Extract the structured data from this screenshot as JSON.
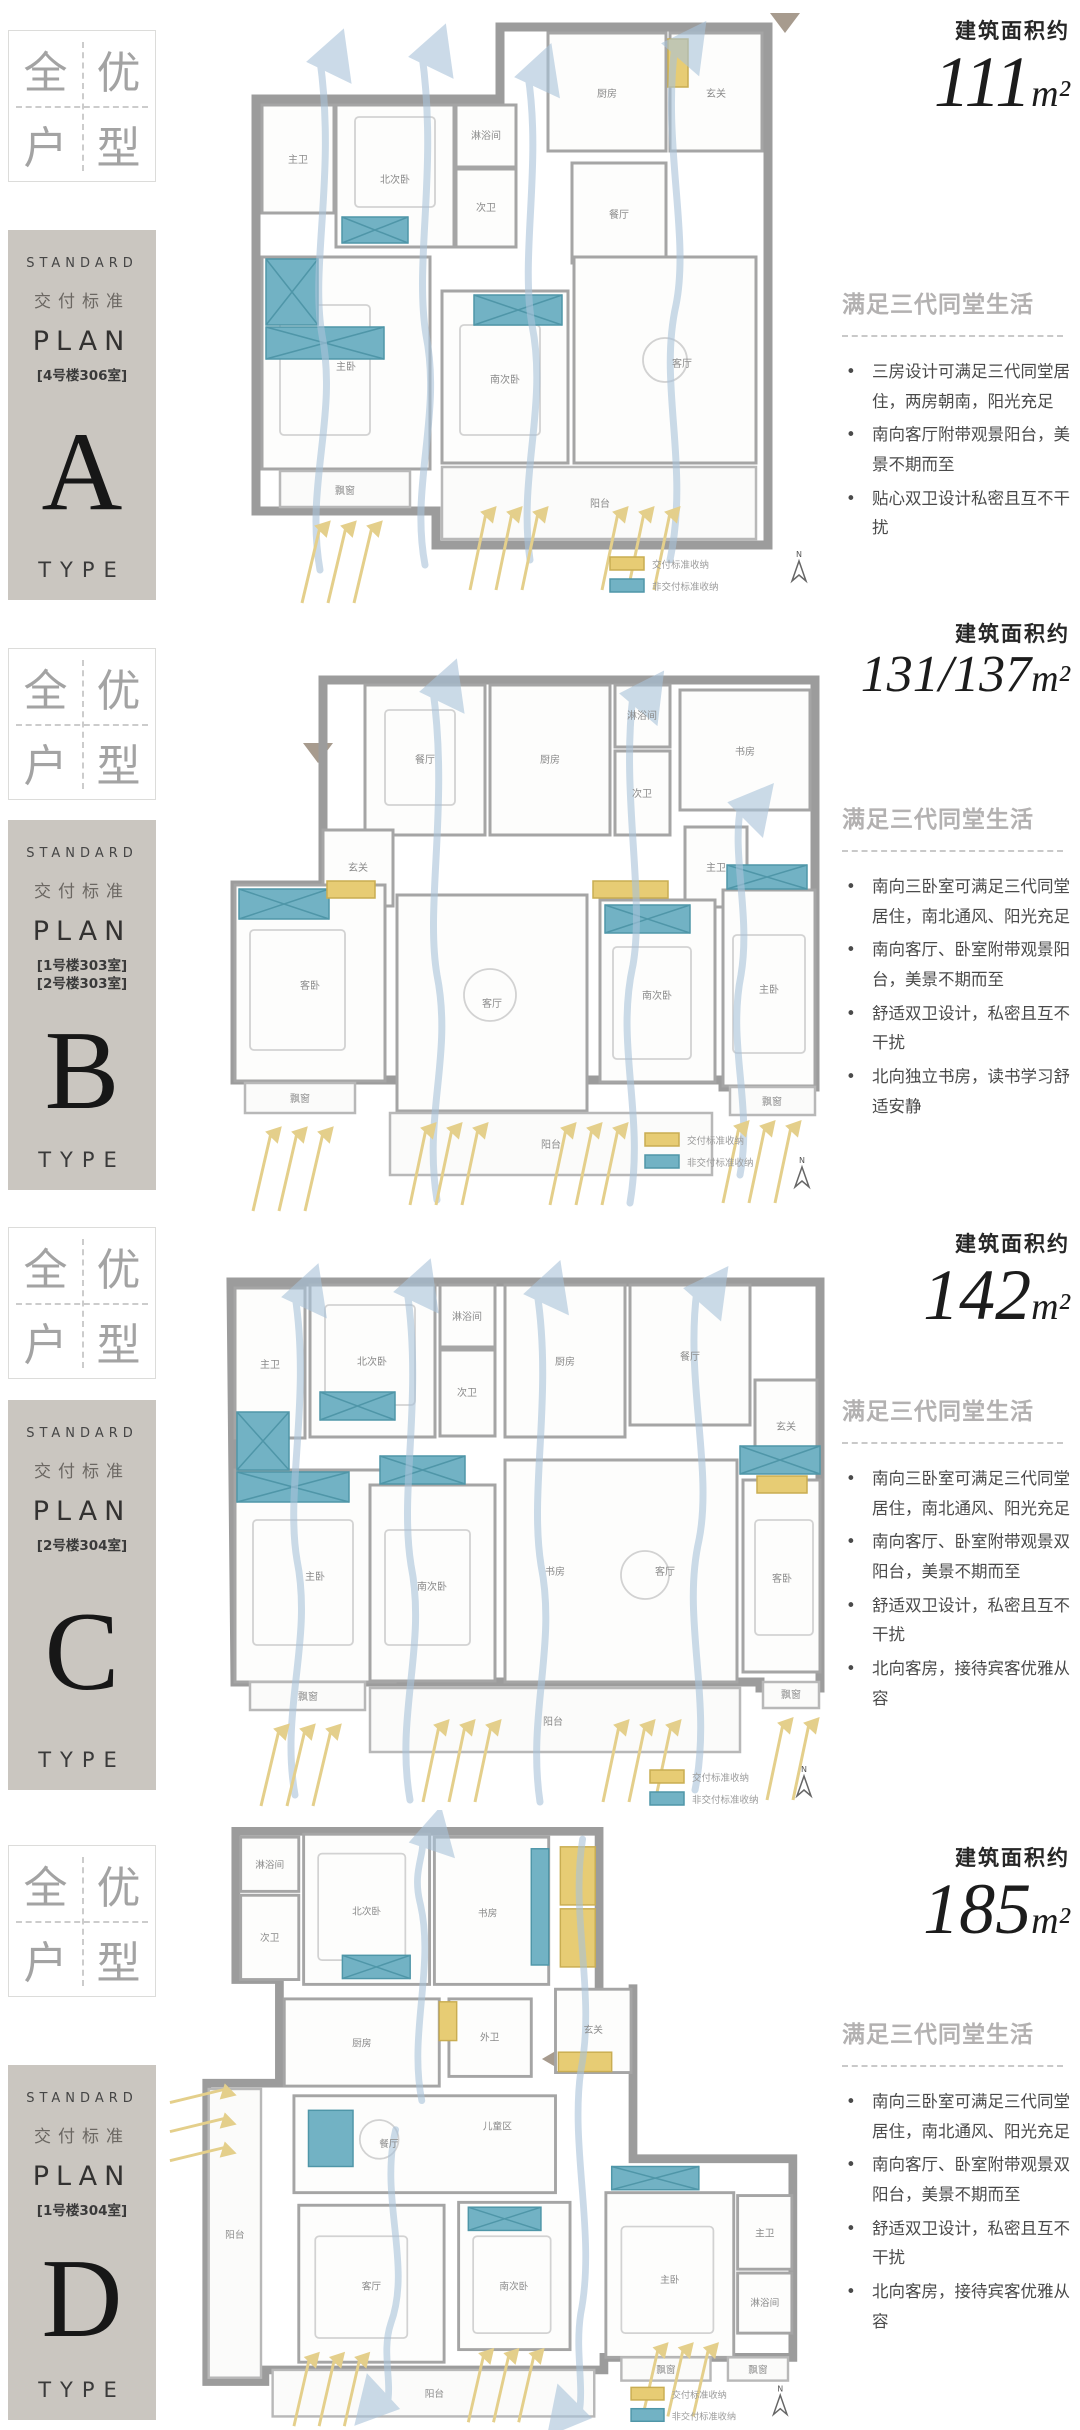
{
  "badge": {
    "chars": [
      "全",
      "优",
      "户",
      "型"
    ]
  },
  "legend": {
    "delivered": "交付标准收纳",
    "non_delivered": "非交付标准收纳",
    "north": "N"
  },
  "sections": [
    {
      "id": "A",
      "card": {
        "standard": "STANDARD",
        "cn": "交付标准",
        "plan": "PLAN",
        "rooms": [
          "[4号楼306室]"
        ],
        "letter": "A",
        "type": "TYPE"
      },
      "area": {
        "label": "建筑面积约",
        "value": "111",
        "unit": "m²"
      },
      "desc": {
        "title": "满足三代同堂生活",
        "bullets": [
          "三房设计可满足三代同堂居住，两房朝南，阳光充足",
          "南向客厅附带观景阳台，美景不期而至",
          "贴心双卫设计私密且互不干扰"
        ]
      },
      "rooms": [
        "主卫",
        "北次卧",
        "淋浴间",
        "次卫",
        "厨房",
        "玄关",
        "餐厅",
        "主卧",
        "南次卧",
        "客厅",
        "飘窗",
        "阳台"
      ]
    },
    {
      "id": "B",
      "card": {
        "standard": "STANDARD",
        "cn": "交付标准",
        "plan": "PLAN",
        "rooms": [
          "[1号楼303室]",
          "[2号楼303室]"
        ],
        "letter": "B",
        "type": "TYPE"
      },
      "area": {
        "label": "建筑面积约",
        "value": "131/137",
        "unit": "m²"
      },
      "desc": {
        "title": "满足三代同堂生活",
        "bullets": [
          "南向三卧室可满足三代同堂居住，南北通风、阳光充足",
          "南向客厅、卧室附带观景阳台，美景不期而至",
          "舒适双卫设计，私密且互不干扰",
          "北向独立书房，读书学习舒适安静"
        ]
      },
      "rooms": [
        "餐厅",
        "厨房",
        "淋浴间",
        "次卫",
        "书房",
        "玄关",
        "主卫",
        "客卧",
        "客厅",
        "南次卧",
        "主卧",
        "飘窗",
        "飘窗",
        "阳台"
      ]
    },
    {
      "id": "C",
      "card": {
        "standard": "STANDARD",
        "cn": "交付标准",
        "plan": "PLAN",
        "rooms": [
          "[2号楼304室]"
        ],
        "letter": "C",
        "type": "TYPE"
      },
      "area": {
        "label": "建筑面积约",
        "value": "142",
        "unit": "m²"
      },
      "desc": {
        "title": "满足三代同堂生活",
        "bullets": [
          "南向三卧室可满足三代同堂居住，南北通风、阳光充足",
          "南向客厅、卧室附带观景双阳台，美景不期而至",
          "舒适双卫设计，私密且互不干扰",
          "北向客房，接待宾客优雅从容"
        ]
      },
      "rooms": [
        "主卫",
        "北次卧",
        "淋浴间",
        "次卫",
        "厨房",
        "餐厅",
        "玄关",
        "主卧",
        "南次卧",
        "书房",
        "客厅",
        "客卧",
        "飘窗",
        "飘窗",
        "阳台"
      ]
    },
    {
      "id": "D",
      "card": {
        "standard": "STANDARD",
        "cn": "交付标准",
        "plan": "PLAN",
        "rooms": [
          "[1号楼304室]"
        ],
        "letter": "D",
        "type": "TYPE"
      },
      "area": {
        "label": "建筑面积约",
        "value": "185",
        "unit": "m²"
      },
      "desc": {
        "title": "满足三代同堂生活",
        "bullets": [
          "南向三卧室可满足三代同堂居住，南北通风、阳光充足",
          "南向客厅、卧室附带观景双阳台，美景不期而至",
          "舒适双卫设计，私密且互不干扰",
          "北向客房，接待宾客优雅从容"
        ]
      },
      "rooms": [
        "淋浴间",
        "次卫",
        "北次卧",
        "书房",
        "厨房",
        "外卫",
        "玄关",
        "餐厅",
        "儿童区",
        "客厅",
        "南次卧",
        "主卧",
        "主卫",
        "淋浴间",
        "阳台",
        "阳台",
        "飘窗",
        "飘窗"
      ]
    }
  ]
}
